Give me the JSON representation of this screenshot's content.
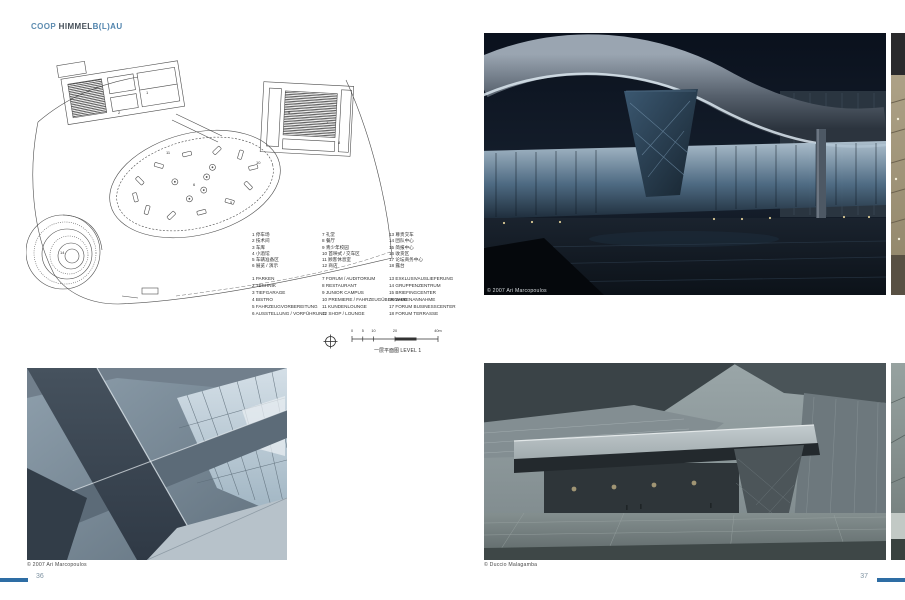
{
  "brand": {
    "coop": "COOP",
    "himmel": "HIMMEL",
    "blau": "B(L)AU"
  },
  "plan": {
    "legend_cn": {
      "col1": [
        "1 停车场",
        "2 技术间",
        "3 车库",
        "4 小酒馆",
        "5 车辆准备区",
        "6 展览 / 演示"
      ],
      "col2": [
        "7 礼堂",
        "8 餐厅",
        "9 青少年校园",
        "10 首映式 / 交车区",
        "11 顾客休息室",
        "12 商店"
      ],
      "col3": [
        "13 尊贵交车",
        "14 团队中心",
        "15 简报中心",
        "16 收货区",
        "17 论坛商务中心",
        "18 露台"
      ]
    },
    "legend_de": {
      "col1": [
        "1 PARKEN",
        "2 TECHNIK",
        "3 TIEFGARAGE",
        "4 BISTRO",
        "5 FAHRZEUGVORBEREITUNG",
        "6 AUSSTELLUNG / VORFÜHRUNG"
      ],
      "col2": [
        "7 FORUM / AUDITORIUM",
        "8 RESTAURANT",
        "9 JUNIOR CAMPUS",
        "10 PREMIERE / FAHRZEUGÜBERGABE",
        "11 KUNDENLOUNGE",
        "12 SHOP / LOUNGE"
      ],
      "col3": [
        "13 EXKLUSIVAUSLIEFERUNG",
        "14 GRUPPENZENTRUM",
        "15 BRIEFINGCENTER",
        "16 WARENANNAHME",
        "17 FORUM BUSINESSCENTER",
        "18 FORUM TERRASSE"
      ]
    },
    "scale_ticks": [
      "0",
      "5",
      "10",
      "20",
      "40m"
    ],
    "title_cn": "一层平面图",
    "title_en": "LEVEL 1"
  },
  "photos": {
    "interior_caption": "© 2007 Ari Marcopoulos",
    "night_caption": "© 2007 Ari Marcopoulos",
    "dusk_caption": "© Duccio Malagamba"
  },
  "pagination": {
    "left": "36",
    "right": "37"
  },
  "colors": {
    "accent_blue": "#2e6da4",
    "brand_blue": "#5d8cb0",
    "brand_dark": "#454f58",
    "page_number_gray": "#7f93a2",
    "plan_line": "#4d4d4d"
  }
}
